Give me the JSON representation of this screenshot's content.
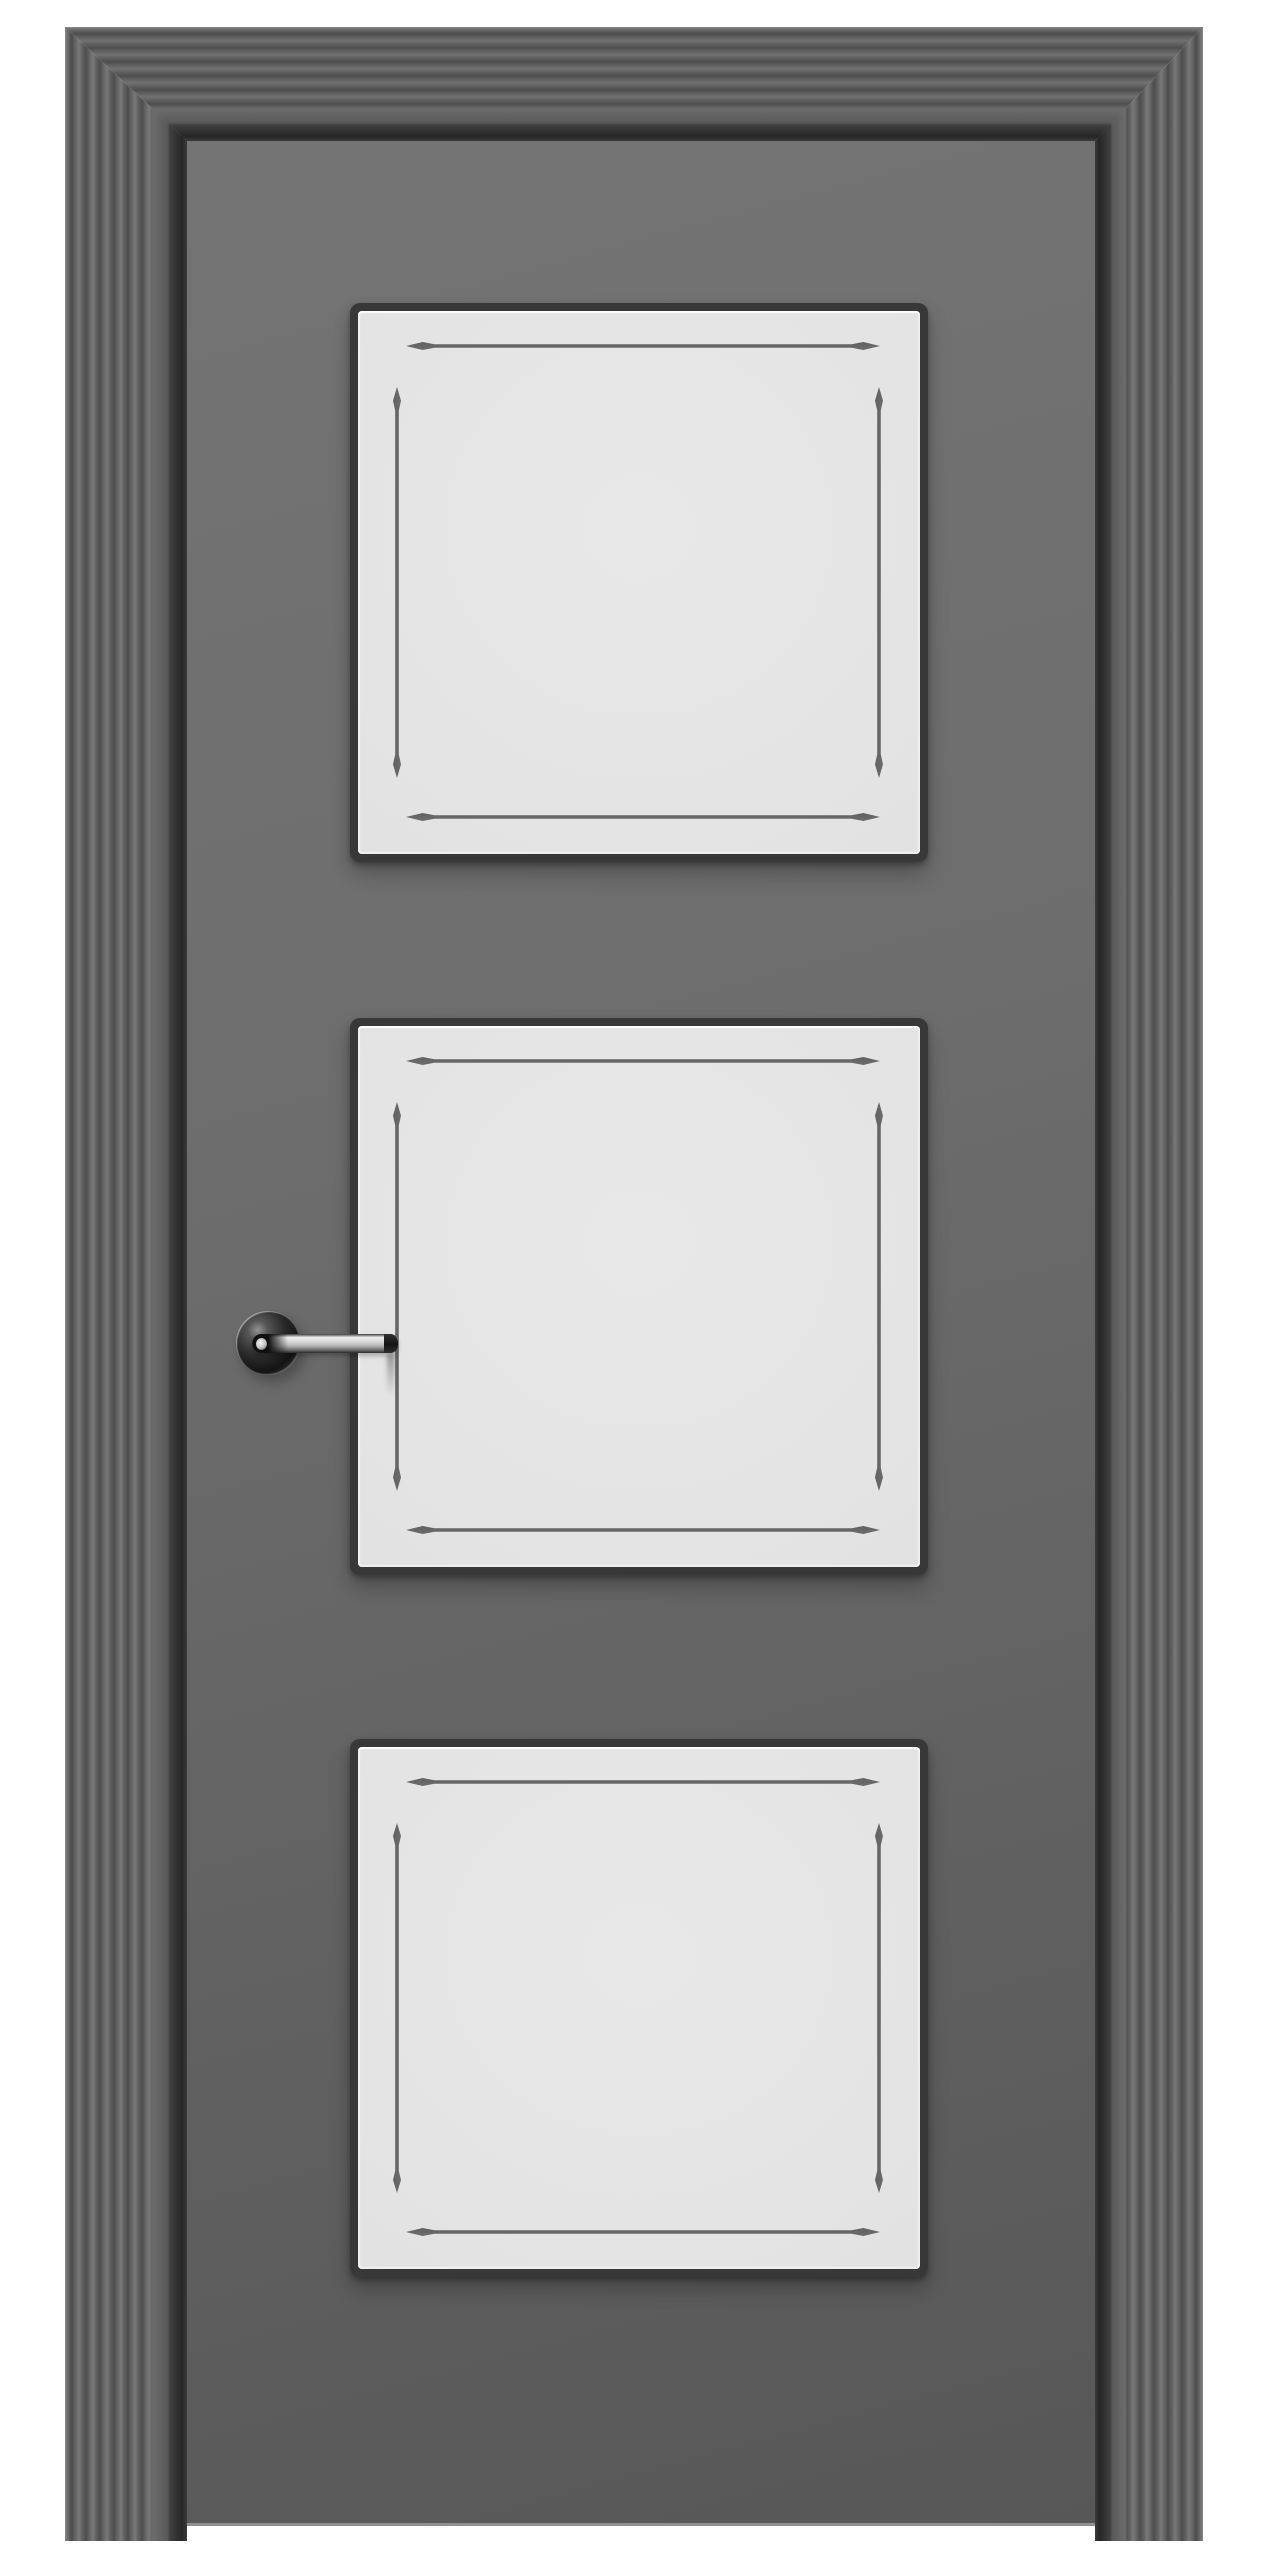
{
  "image": {
    "type": "product-render",
    "subject": "interior door, closed, front view",
    "alt": "Gray interior door in a fluted casing with three square frosted glass panels and a polished chrome lever handle on the left side",
    "background": "#ffffff"
  },
  "door": {
    "frame": {
      "label": "Fluted door casing with mitered corners",
      "sides": [
        "top",
        "left",
        "right"
      ],
      "finish": "graphite gray reeded molding"
    },
    "leaf": {
      "label": "Door leaf",
      "finish": "matte graphite gray"
    },
    "panels": {
      "count": 3,
      "glass": "frosted light gray",
      "accent": "four tapered double-pointed grooves inset along each edge",
      "items": [
        {
          "label": "Top glass panel"
        },
        {
          "label": "Middle glass panel"
        },
        {
          "label": "Bottom glass panel"
        }
      ]
    },
    "handle": {
      "label": "Chrome lever handle",
      "type": "lever on round rosette",
      "finish": "polished chrome",
      "side": "left",
      "parts": {
        "rosette": "Round rosette",
        "lever": "Lever bar",
        "tip": "Lever end cap"
      }
    }
  },
  "colors": {
    "bg": "#ffffff",
    "frameLight": "#8a8a8a",
    "frameMid": "#5f5f5f",
    "frameDark": "#262626",
    "leafLight": "#747474",
    "leafDark": "#575757",
    "panelFace": "#e3e3e3",
    "panelBorder": "#383838",
    "groove": "#6f6f6f",
    "chromeLight": "#f0f0f0",
    "chromeDark": "#141414"
  }
}
